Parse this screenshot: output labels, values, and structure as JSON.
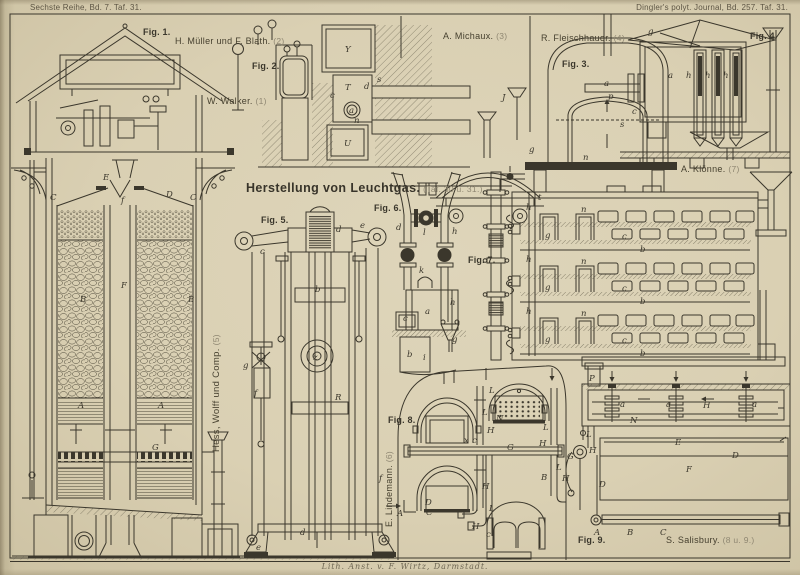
{
  "plate": {
    "header_left": "Sechste Reihe, Bd. 7. Taf. 31.",
    "header_right": "Dingler's polyt. Journal, Bd. 257. Taf. 31.",
    "title": "Herstellung von Leuchtgas.",
    "title_ref": "(Taf. 30 u. 31.)",
    "credit": "Lith. Anst. v. F. Wirtz, Darmstadt."
  },
  "labels": {
    "fig1": "Fig. 1.",
    "fig2": "Fig. 2.",
    "fig3": "Fig. 3.",
    "fig4": "Fig. 4.",
    "fig5": "Fig. 5.",
    "fig6": "Fig. 6.",
    "fig7": "Fig. 7.",
    "fig8": "Fig. 8.",
    "fig9": "Fig. 9."
  },
  "attributions": {
    "walker": {
      "name": "W. Walker.",
      "ref": "(1)"
    },
    "mueller_blath": {
      "name": "H. Müller und F. Blath.",
      "ref": "(2)"
    },
    "michaux": {
      "name": "A. Michaux.",
      "ref": "(3)"
    },
    "fleischhauer": {
      "name": "R. Fleischhauer.",
      "ref": "(4)"
    },
    "hess_wolff": {
      "name": "Hess, Wolff und Comp.",
      "ref": "(5)"
    },
    "lindemann": {
      "name": "E. Lindemann.",
      "ref": "(6)"
    },
    "kloenne": {
      "name": "A. Klönne.",
      "ref": "(7)"
    },
    "salisbury": {
      "name": "S. Salisbury.",
      "ref": "(8 u. 9.)"
    }
  },
  "colors": {
    "paper": "#dad0b3",
    "ink": "#3b372c",
    "ink_light": "#8f8772"
  },
  "letters": {
    "fig1": [
      "C",
      "E",
      "f",
      "D",
      "C",
      "B",
      "F",
      "B",
      "A",
      "A",
      "G"
    ],
    "fig2": [
      "Y",
      "s",
      "d",
      "T",
      "c",
      "a",
      "n",
      "U"
    ],
    "fig3": [
      "J",
      "a",
      "s",
      "n",
      "g"
    ],
    "fig4": [
      "g",
      "a",
      "h",
      "h",
      "h",
      "p",
      "c"
    ],
    "fig5": [
      "e",
      "d",
      "c",
      "b",
      "z",
      "g",
      "R",
      "f",
      "f",
      "d",
      "e"
    ],
    "fig6": [
      "l",
      "d",
      "h",
      "k",
      "a",
      "h",
      "c",
      "b",
      "g",
      "i"
    ],
    "fig7": [
      "t",
      "h",
      "n",
      "g",
      "c",
      "b",
      "h",
      "n",
      "g",
      "c",
      "b",
      "h",
      "n",
      "g",
      "c",
      "b"
    ],
    "fig8_furnace": [
      "L",
      "L",
      "N",
      "H",
      "x",
      "c",
      "G",
      "L",
      "H",
      "L",
      "B",
      "H",
      "A",
      "D",
      "C",
      "L",
      "H",
      "c"
    ],
    "fig8_bench": [
      "P",
      "a",
      "N",
      "a",
      "H",
      "a",
      "E",
      "D",
      "L",
      "G",
      "H",
      "H",
      "D",
      "F"
    ],
    "fig9": [
      "A",
      "B",
      "C"
    ]
  }
}
